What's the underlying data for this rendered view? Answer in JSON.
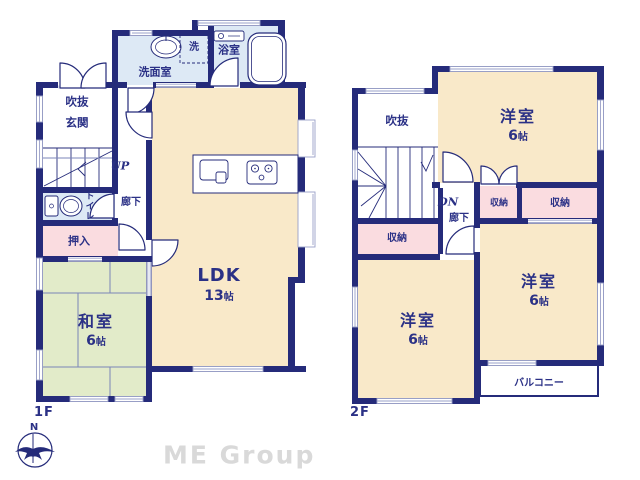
{
  "colors": {
    "wall_navy": "#252b7a",
    "label_navy": "#2b3186",
    "room_cream": "#f9e9c9",
    "room_green": "#e2ebc9",
    "room_pink": "#fadce0",
    "room_blue": "#dde9f5",
    "window_line": "#9aa0c8",
    "watermark_gray": "#d9d9d9"
  },
  "floor1": {
    "label": "1F",
    "stair_direction": "UP",
    "rooms": {
      "washroom": "洗面室",
      "laundry": "洗",
      "bath": "浴室",
      "void": "吹抜",
      "entrance": "玄関",
      "toilet": "トイレ",
      "hall": "廊下",
      "closet": "押入",
      "washitsu": {
        "name": "和室",
        "num": "6",
        "unit": "帖"
      },
      "ldk": {
        "name": "LDK",
        "num": "13",
        "unit": "帖"
      }
    }
  },
  "floor2": {
    "label": "2F",
    "stair_direction": "DN",
    "rooms": {
      "void": "吹抜",
      "hall": "廊下",
      "closet_hall": "収納",
      "closet_small": "収納",
      "closet_wide": "収納",
      "room_north": {
        "name": "洋室",
        "num": "6",
        "unit": "帖"
      },
      "room_southeast": {
        "name": "洋室",
        "num": "6",
        "unit": "帖"
      },
      "room_southwest": {
        "name": "洋室",
        "num": "6",
        "unit": "帖"
      },
      "balcony": "バルコニー"
    }
  },
  "footer": {
    "compass_north": "N",
    "watermark": "ME Group"
  }
}
